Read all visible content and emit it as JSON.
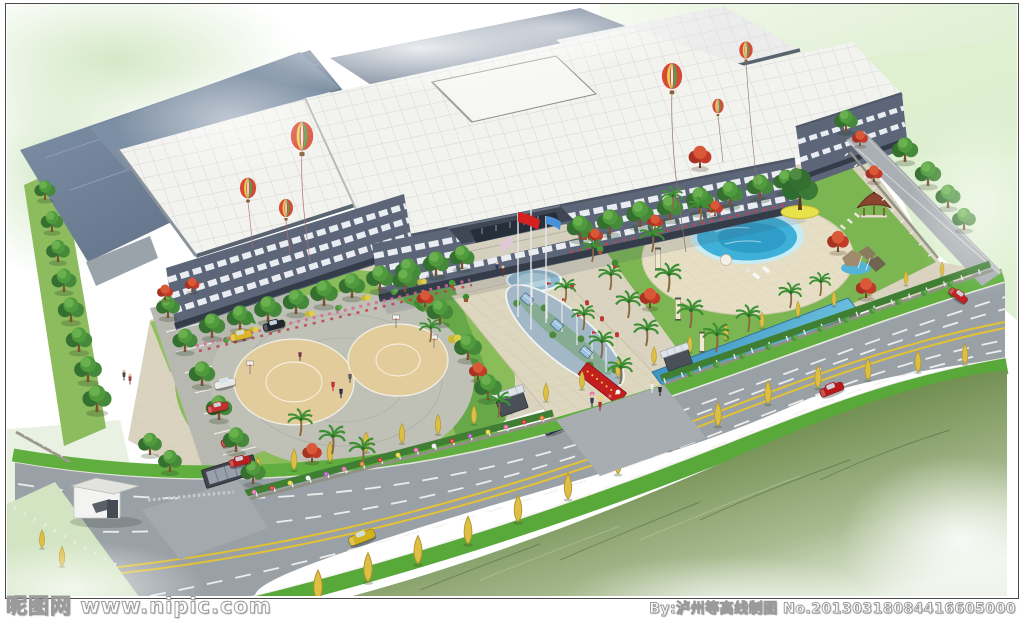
{
  "watermark": {
    "site_name": "昵图网",
    "site_url": "www.nipic.com",
    "credit": "By:泸州等高线制图",
    "serial": "No.20130318084416605000"
  },
  "palette": {
    "frame-line": "#4a4a4a",
    "watermark-color": "#fdfdfd",
    "roof-white": "#f2f2ef",
    "roof-slate": "#6b7d94",
    "facade": "#5c6678",
    "facade-band": "#e9edf1",
    "paving": "#d9d3c0",
    "plaza": "#bfc0b6",
    "court": "#e3cc9c",
    "lawn": "#85b957",
    "lawn-bright": "#94c765",
    "verge": "#5fae3e",
    "road": "#9aa1a6",
    "line-yellow": "#e2c235",
    "pool": "#3fb0d8",
    "water": "#2f86b8",
    "tree": "#4e9a3c",
    "palm": "#3f8f34",
    "poplar": "#ddbf45",
    "red-foliage": "#c23a28",
    "flower-pink": "#e06aa8",
    "grass-dark": "#3f5a2a",
    "balloon-red": "#d84a38",
    "balloon-yellow": "#e8d44d",
    "balloon-green": "#4fa349"
  }
}
